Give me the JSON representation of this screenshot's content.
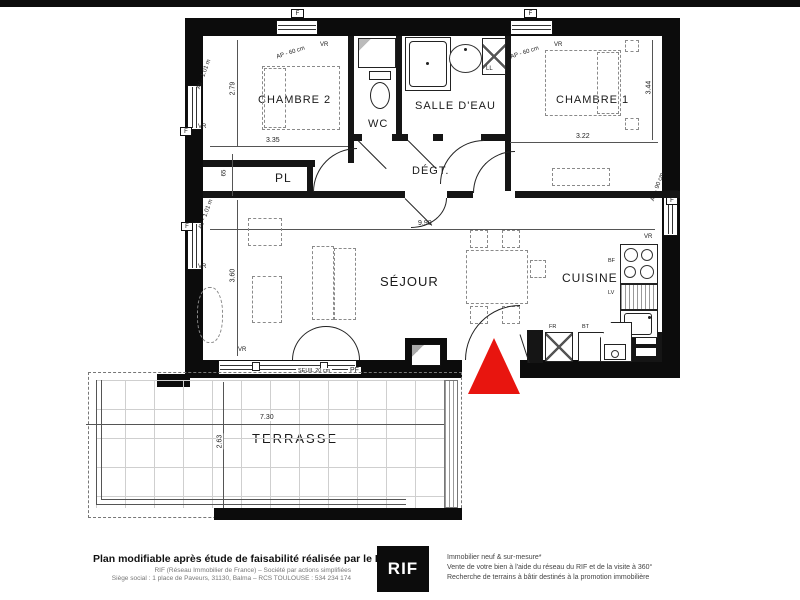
{
  "plan": {
    "rooms": {
      "chambre2": "CHAMBRE 2",
      "wc": "WC",
      "salle_deau": "SALLE D'EAU",
      "chambre1": "CHAMBRE 1",
      "degagement": "DÉGT.",
      "placard_couloir": "PL",
      "sejour": "SÉJOUR",
      "cuisine": "CUISINE",
      "placard_cuisine": "PL",
      "terrasse": "TERRASSE"
    },
    "dimensions": {
      "chambre2_height": "2.79",
      "chambre2_width": "3.35",
      "chambre1_width": "3.22",
      "chambre1_height": "3.44",
      "placard_depth": "65",
      "sejour_width": "9.90",
      "sejour_height": "3.60",
      "terrasse_width": "7.30",
      "terrasse_depth": "2.63",
      "seuil": "SEUIL 20 cm"
    },
    "openings": {
      "fenetre": "F",
      "volet_roulant": "VR",
      "allege_60": "AP - 60 cm",
      "allege_90": "AP - 90 cm",
      "av_101": "AV - 1.01 m",
      "porte_fenetre": "PF"
    },
    "equipment": {
      "lave_linge": "LL",
      "plaque": "BF",
      "lave_vaisselle": "LV",
      "refrigerateur": "FR",
      "bloc_technique": "BT"
    },
    "accent_red": "#e8150f"
  },
  "footer": {
    "headline": "Plan modifiable après étude de faisabilité réalisée par le RIF",
    "line2": "RIF (Réseau Immobilier de France) – Société par actions simplifiées",
    "line3": "Siège social : 1 place de Paveurs, 31130, Balma – RCS TOULOUSE : 534 234 174",
    "logo": "RIF",
    "right1": "Immobilier neuf & sur-mesure*",
    "right2": "Vente de votre bien à l'aide du réseau du RIF et de la visite à 360°",
    "right3": "Recherche de terrains à bâtir destinés à la promotion immobilière"
  }
}
